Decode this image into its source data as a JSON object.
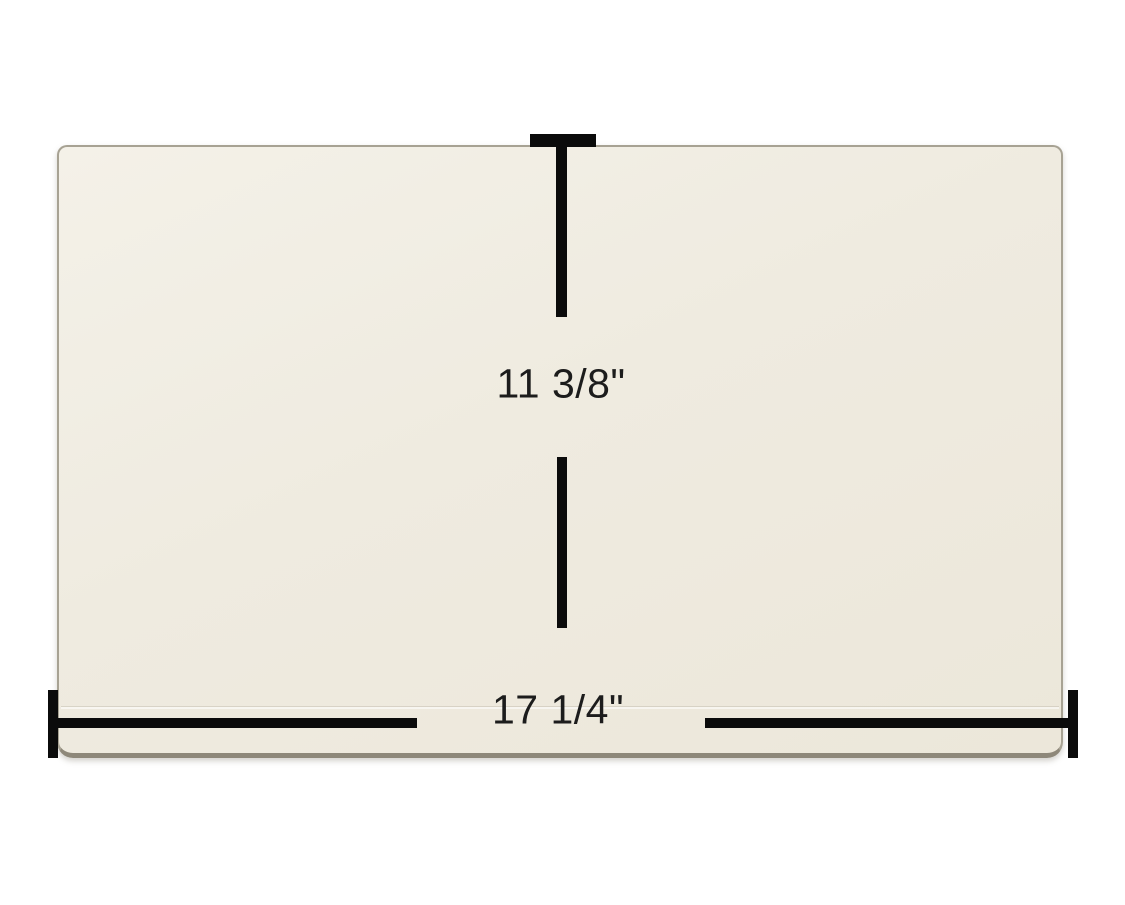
{
  "image": {
    "description": "Rectangular cream ceramic glass panel shown with height and width dimension callouts"
  },
  "dimensions": {
    "height_label": "11 3/8\"",
    "width_label": "17 1/4\""
  },
  "colors": {
    "page_bg": "#ffffff",
    "panel_fill": "#efebe0",
    "panel_fill_light": "#f4f1e8",
    "panel_edge": "#a7a293",
    "panel_bottom_edge": "#8e887a",
    "dim_line": "#0b0b0b",
    "label_text": "#1c1c1c"
  }
}
